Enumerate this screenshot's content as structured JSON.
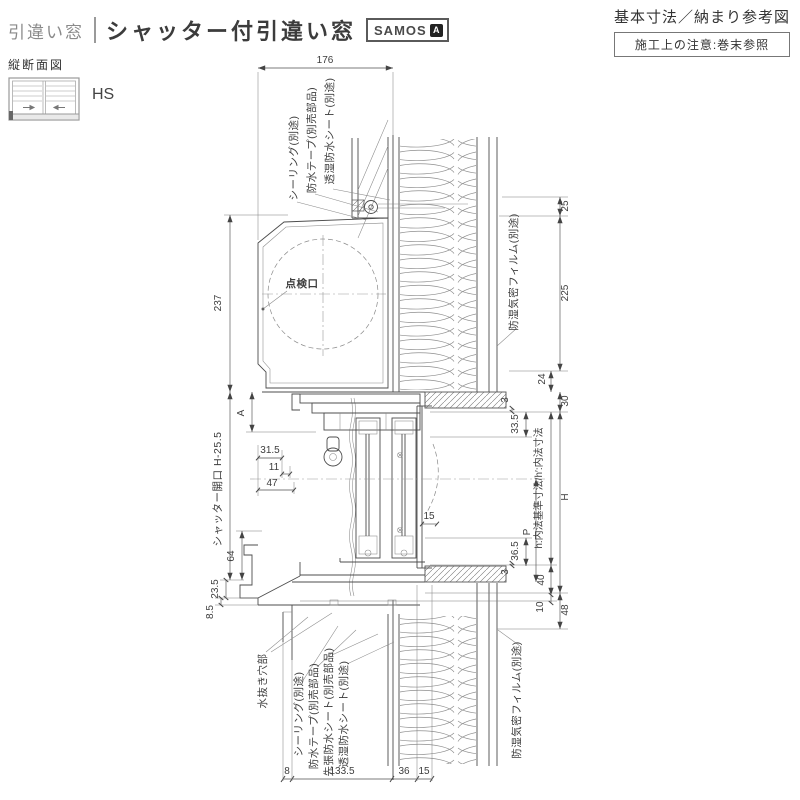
{
  "header": {
    "category": "引違い窓",
    "title": "シャッター付引違い窓",
    "brand": "SAMOS",
    "brand_mark": "A",
    "subtitle": "基本寸法／納まり参考図",
    "note": "施工上の注意:巻末参照"
  },
  "sidebar": {
    "section_label": "縦断面図",
    "series_label": "HS"
  },
  "labels": {
    "sealing_top": "シーリング(別途)",
    "tape_top": "防水テープ(別売部品)",
    "sheet_top": "透湿防水シート(別途)",
    "film_top": "防湿気密フィルム(別途)",
    "inspection": "点検口",
    "shutter_opening": "シャッター開口 H-25.5",
    "naiho": "h:内法基準寸法/h′:内法寸法",
    "drain": "水抜き穴部",
    "sealing_bottom": "シーリング(別途)",
    "tape_bottom": "防水テープ(別売部品)",
    "pre_sheet_bottom": "先張防水シート(別売部品)",
    "sheet_bottom": "透湿防水シート(別途)",
    "film_bottom": "防湿気密フィルム(別途)"
  },
  "dims": {
    "w176": "176",
    "d25": "25",
    "d225": "225",
    "d24": "24",
    "d30": "30",
    "d3a": "3",
    "d33_5": "33.5",
    "dH": "H",
    "dP": "P",
    "d36_5": "36.5",
    "d3b": "3",
    "d40": "40",
    "d10": "10",
    "d48": "48",
    "d237": "237",
    "dA": "A",
    "d31_5": "31.5",
    "d11": "11",
    "d47": "47",
    "d15m": "15",
    "d64": "64",
    "d23_5": "23.5",
    "d8_5": "8.5",
    "d8": "8",
    "d133_5": "133.5",
    "d36": "36",
    "d15b": "15"
  }
}
